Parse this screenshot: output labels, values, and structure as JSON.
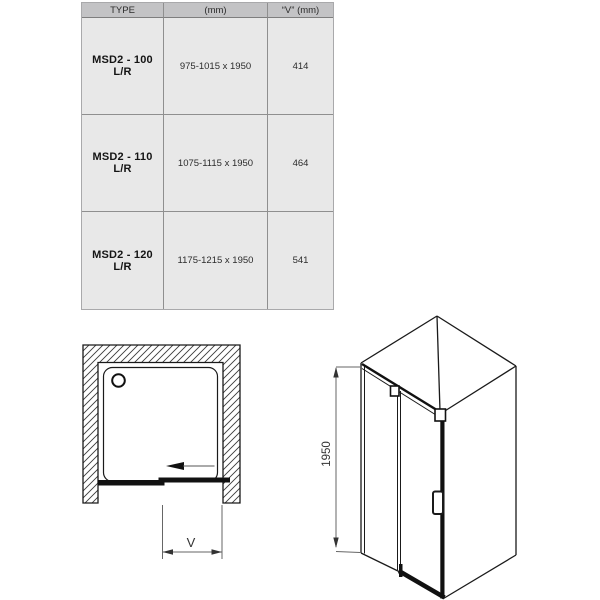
{
  "table": {
    "headers": [
      "TYPE",
      "(mm)",
      "“V” (mm)"
    ],
    "rows": [
      {
        "type": "MSD2 - 100 L/R",
        "mm": "975-1015 x 1950",
        "v": "414"
      },
      {
        "type": "MSD2 - 110 L/R",
        "mm": "1075-1115 x 1950",
        "v": "464"
      },
      {
        "type": "MSD2 - 120 L/R",
        "mm": "1175-1215 x 1950",
        "v": "541"
      }
    ]
  },
  "diagrams": {
    "top_view": {
      "dimension_label": "V"
    },
    "perspective_view": {
      "height_label": "1950"
    }
  },
  "colors": {
    "header_bg": "#c3c3c5",
    "cell_bg": "#e8e8e8",
    "grid_line": "#8f8f8f",
    "drawing_line": "#1a1a1a",
    "dimension_line": "#666666"
  }
}
